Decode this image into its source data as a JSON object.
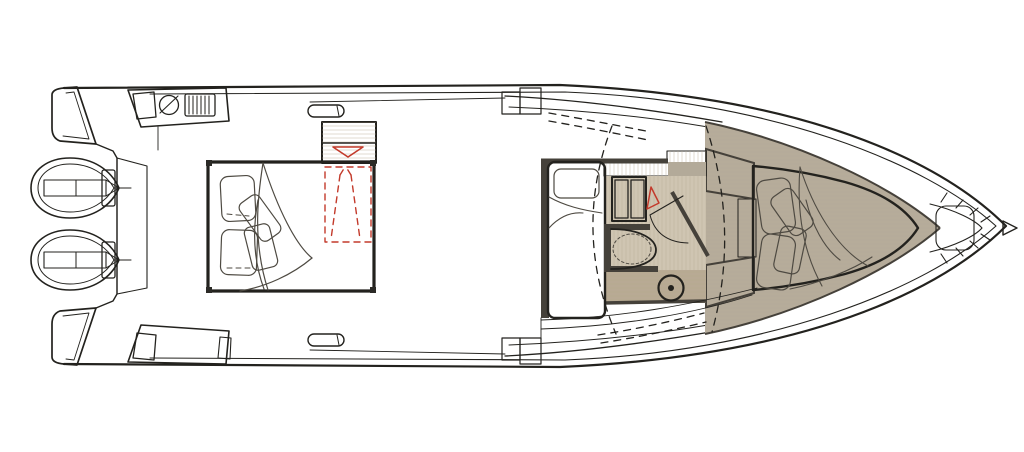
{
  "title": "Motor yacht deck and cabin floor plan (top view)",
  "colors": {
    "outline": "#23221e",
    "pillowLine": "#4e4a42",
    "wall": "#45413a",
    "cream": "#eae4d4",
    "creamLight": "#efeadc",
    "tan": "#d6cbb6",
    "floor": "#cfc5b2",
    "strip": "#c6bcab",
    "stripDark": "#b3aa99",
    "taupe": "#b5ab9a",
    "taupeDark": "#a89e8c",
    "bandTan": "#b7aa92",
    "hatch": "#b9ad99",
    "red": "#c33a2b",
    "white": "#ffffff"
  },
  "features": {
    "engines": "twin outboard engines at transom",
    "wet_bar": "aft wet-bar module with sink and grill vent",
    "transom_seat": "aft bench module",
    "grab_rails": "side grab rails",
    "side_steps": "side boarding steps",
    "aft_cabin": "aft cabin double berth with pillows and blanket",
    "companionway": "companionway steps cabinet with red entry arrow",
    "headroom_hatch": "red dashed standing-headroom / access outline",
    "mid_berth": "mid-cabin single berth",
    "locker": "two-door storage locker",
    "door_swing": "cabin door swing arc",
    "head": "enclosed head with toilet",
    "pedestal": "table pedestal mount",
    "windshield": "wraparound windshield",
    "bow_berth": "bow V-berth with pillows and blanket",
    "anchor_locker": "bow anchor locker",
    "hardtop": "dashed hardtop overhead outline"
  }
}
